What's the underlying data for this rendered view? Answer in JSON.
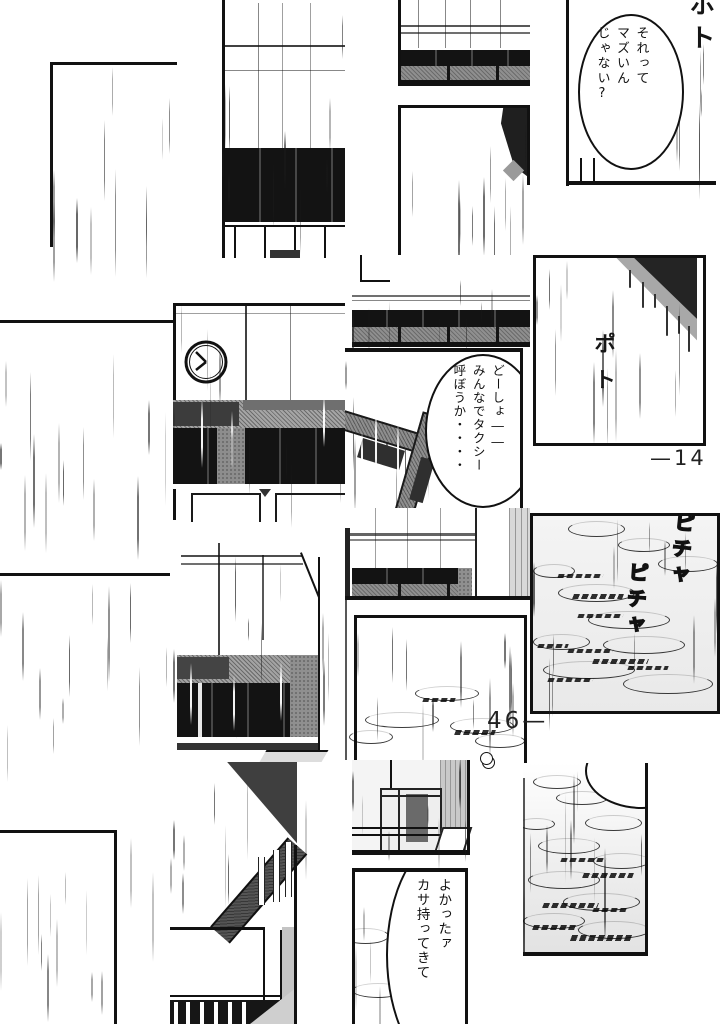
{
  "bubbles": {
    "top_right": {
      "text": "それって\nマズいん\nじゃない?"
    },
    "taxi": {
      "text": "どーしょ――\nみんなでタクシー\n呼ぼうか・・・・"
    },
    "umbrella": {
      "text": "よかったァ\nカサ持ってきて"
    }
  },
  "sfx": {
    "poto_top": "ポト",
    "poto_mid": "ポト",
    "picha_a": "ピチャ",
    "picha_b": "ピチャ"
  },
  "page_numbers": {
    "right": "—14",
    "left": "46—"
  },
  "colors": {
    "ink": "#151515",
    "paper": "#ffffff",
    "tone_gray": "#8f8f8f",
    "tone_light": "#ececec"
  }
}
